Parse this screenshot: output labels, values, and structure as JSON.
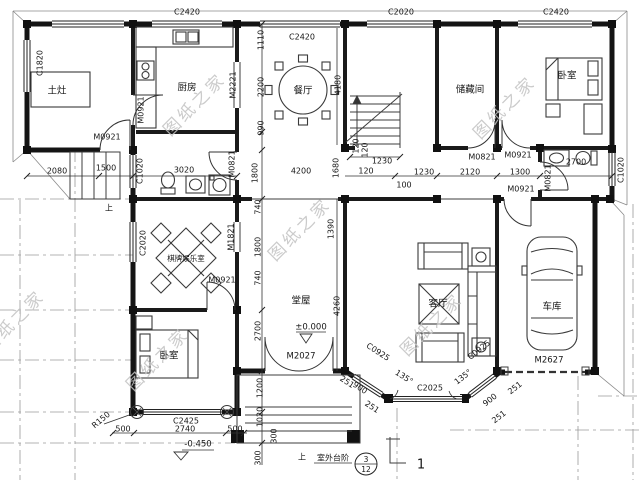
{
  "drawing": {
    "rooms": {
      "stove": "土灶",
      "kitchen": "厨房",
      "dining": "餐厅",
      "storage": "储藏间",
      "bedroom": "卧室",
      "game_room": "棋牌娱乐室",
      "hall": "堂屋",
      "living": "客厅",
      "garage": "车库",
      "outdoor_steps": "室外台阶",
      "up": "上"
    },
    "windows": {
      "c1820": "C1820",
      "c2420": "C2420",
      "c2020": "C2020",
      "c1020": "C1020",
      "c2425": "C2425",
      "c2025": "C2025",
      "c0925": "C0925"
    },
    "doors": {
      "m0921": "M0921",
      "m2221": "M2221",
      "m0821": "M0821",
      "m1821": "M1821",
      "m2027": "M2027",
      "m2627": "M2627"
    },
    "dims": {
      "d2080": "2080",
      "d1500": "1500",
      "d3020": "3020",
      "d1110": "1110",
      "d2200": "2200",
      "d990": "990",
      "d4180": "4180",
      "d1230": "1230",
      "d120": "120",
      "d100": "100",
      "d2120": "2120",
      "d1300": "1300",
      "d2700": "2700",
      "d1800": "1800",
      "d4200": "4200",
      "d1680": "1680",
      "d740": "740",
      "d1390": "1390",
      "d4260": "4260",
      "d1200": "1200",
      "d1020": "1020",
      "d300": "300",
      "d500": "500",
      "d2740": "2740",
      "d900": "900",
      "d251": "251",
      "a135": "135°",
      "r150": "R150"
    },
    "levels": {
      "ground": "±0.000",
      "porch": "-0.450"
    },
    "marks": {
      "detail_num": "3",
      "detail_sheet": "12",
      "section": "1"
    },
    "watermark": {
      "text": "图纸之家"
    }
  }
}
